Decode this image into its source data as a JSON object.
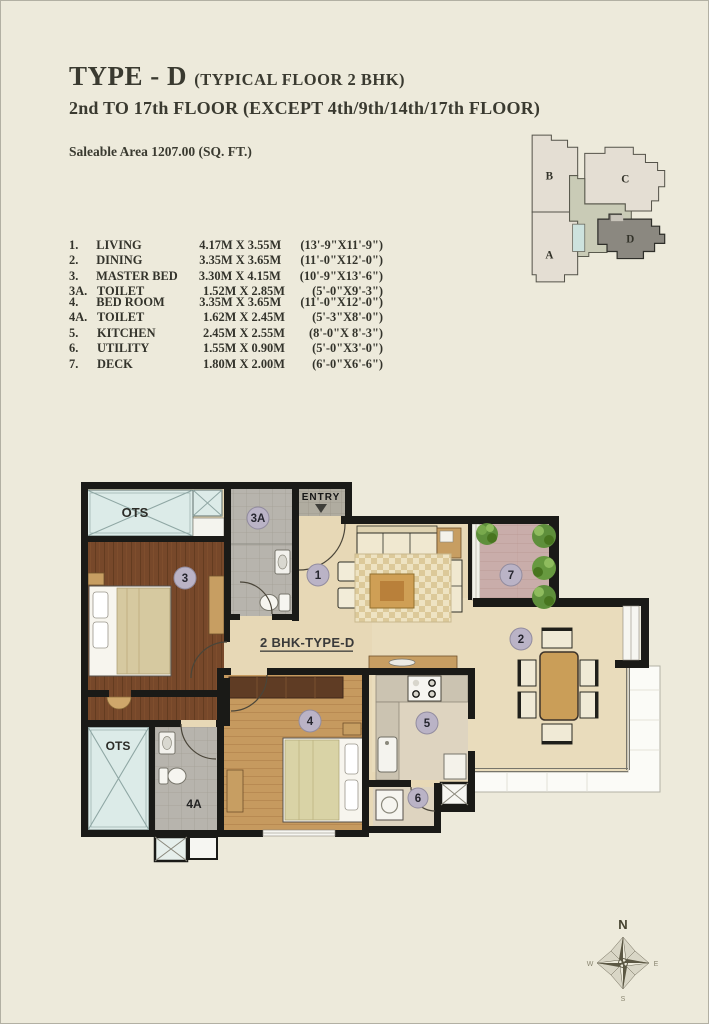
{
  "page": {
    "title_main": "TYPE - D",
    "title_paren": "(TYPICAL FLOOR 2 BHK)",
    "title_line2": "2nd TO 17th FLOOR (EXCEPT 4th/9th/14th/17th FLOOR)",
    "saleable_area": "Saleable Area 1207.00 (SQ. FT.)"
  },
  "room_table": {
    "rows": [
      {
        "num": "1.",
        "name": "LIVING",
        "metric": "4.17M X 3.55M",
        "imperial": "(13'-9\"X11'-9\")"
      },
      {
        "num": "2.",
        "name": "DINING",
        "metric": "3.35M X 3.65M",
        "imperial": "(11'-0\"X12'-0\")"
      },
      {
        "num": "3.",
        "name": "MASTER BED",
        "metric": "3.30M X 4.15M",
        "imperial": "(10'-9\"X13'-6\")"
      },
      {
        "num": "3A.",
        "name": "TOILET",
        "metric": "1.52M X 2.85M",
        "imperial": "(5'-0\"X9'-3\")"
      },
      {
        "num": "4.",
        "name": "BED ROOM",
        "metric": "3.35M X 3.65M",
        "imperial": "(11'-0\"X12'-0\")"
      },
      {
        "num": "4A.",
        "name": "TOILET",
        "metric": "1.62M X 2.45M",
        "imperial": "(5'-3\"X8'-0\")"
      },
      {
        "num": "5.",
        "name": "KITCHEN",
        "metric": "2.45M X 2.55M",
        "imperial": "(8'-0\"X 8'-3\")"
      },
      {
        "num": "6.",
        "name": "UTILITY",
        "metric": "1.55M X 0.90M",
        "imperial": "(5'-0\"X3'-0\")"
      },
      {
        "num": "7.",
        "name": "DECK",
        "metric": "1.80M X 2.00M",
        "imperial": "(6'-0\"X6'-6\")"
      }
    ]
  },
  "key_plan": {
    "a": "A",
    "b": "B",
    "c": "C",
    "d": "D"
  },
  "floor_plan": {
    "unit_label": "2 BHK-TYPE-D",
    "entry_label": "ENTRY",
    "ots_top": "OTS",
    "ots_bottom": "OTS",
    "labels": {
      "living": "1",
      "dining": "2",
      "master_bed": "3",
      "toilet3a": "3A",
      "bed": "4",
      "toilet4a": "4A",
      "kitchen": "5",
      "utility": "6",
      "deck": "7"
    }
  },
  "compass": {
    "n": "N",
    "e": "E",
    "s": "S",
    "w": "W"
  },
  "colors": {
    "page_bg": "#edeadb",
    "wall": "#1a1a17",
    "floor_beige": "#e7d8b6",
    "wood_dark": "#77482a",
    "wood_light": "#c69a5f",
    "tile_gray": "#b7b4ad",
    "deck_floor": "#c9adaa",
    "ots_cyan": "#dcebe8",
    "label_circle": "#bab3c6",
    "balcony_white": "#fbfbf7",
    "plant_green": "#5e8f3b",
    "building_d_gray": "#8b8880",
    "keyplan_green": "#c9cbb6"
  }
}
